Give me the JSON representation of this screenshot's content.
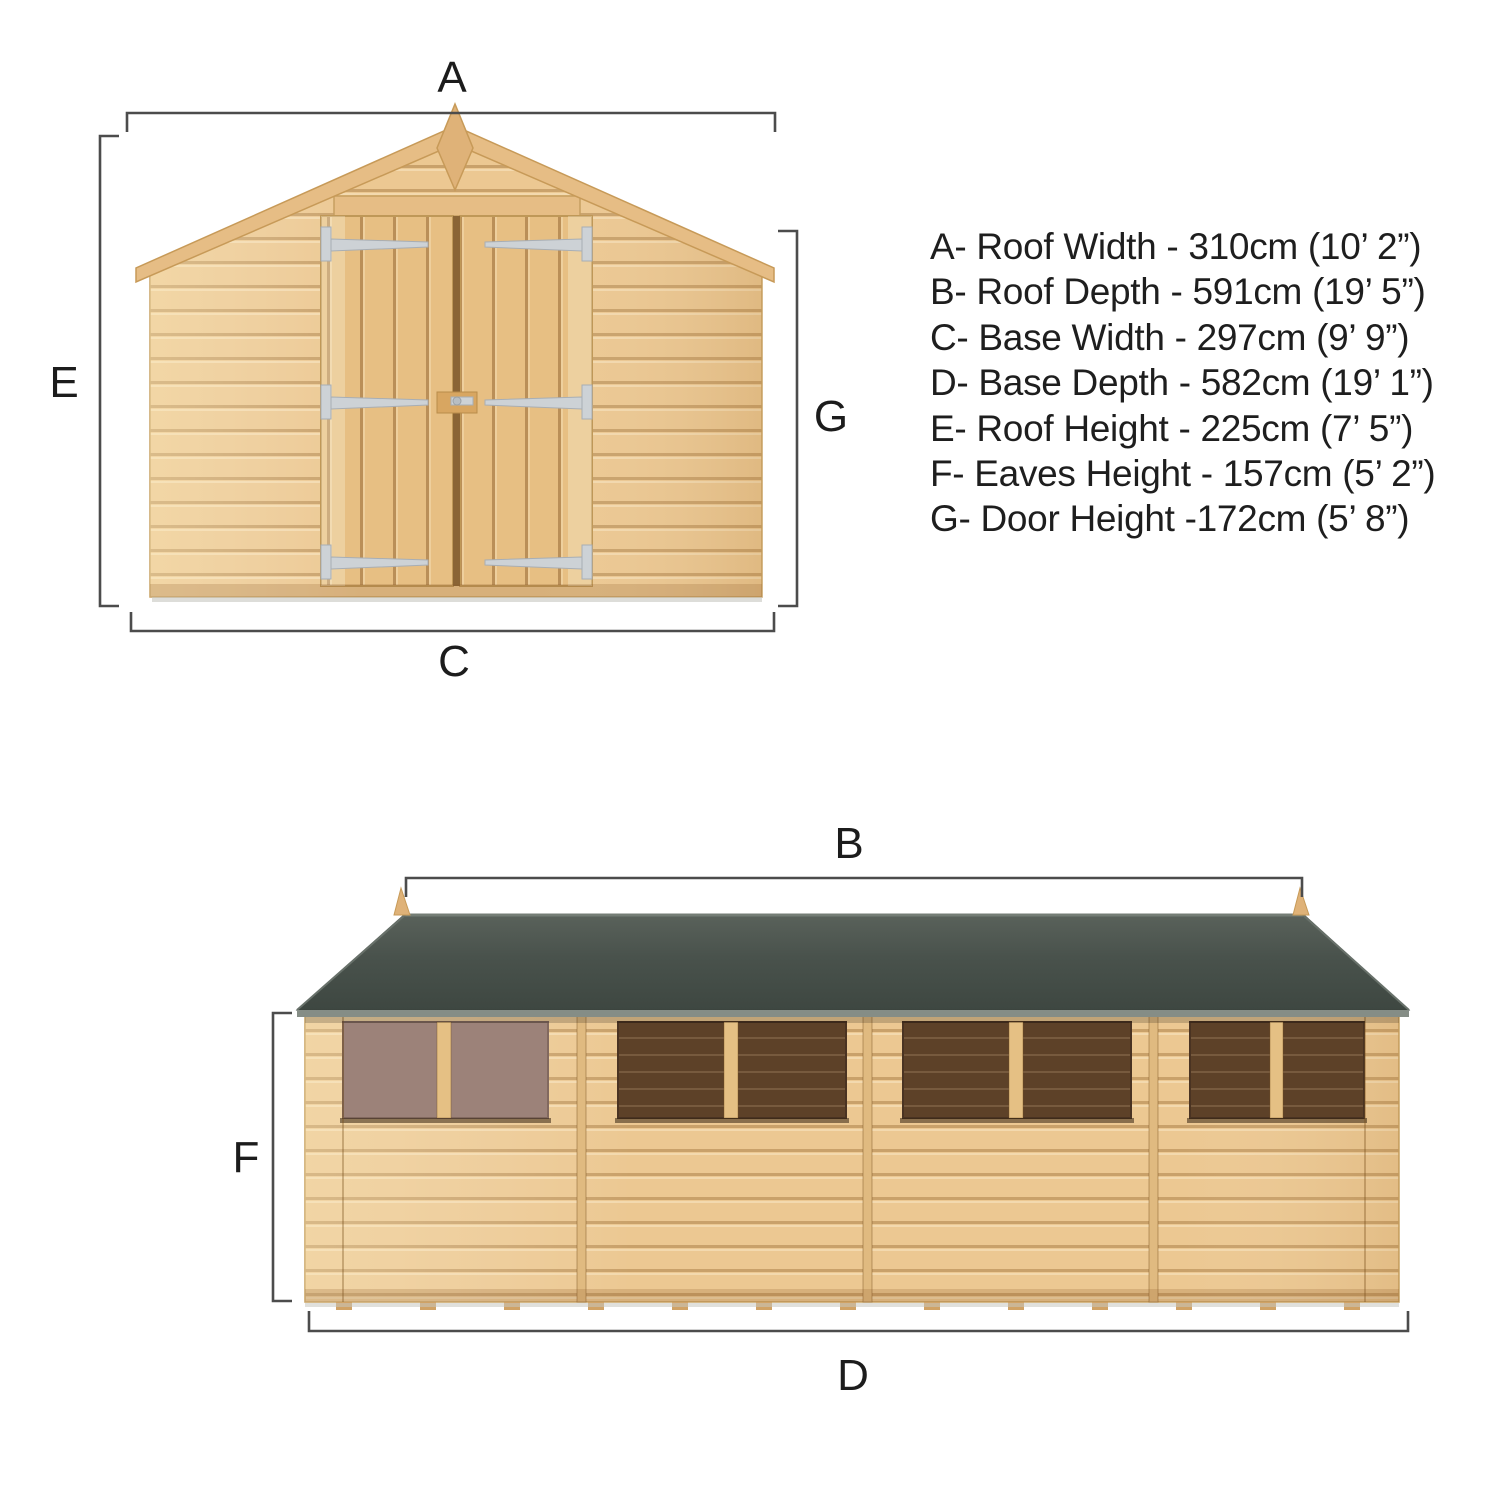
{
  "legend": {
    "items": [
      "A- Roof Width - 310cm (10’ 2”)",
      "B- Roof Depth - 591cm (19’ 5”)",
      "C- Base Width - 297cm (9’ 9”)",
      "D- Base Depth - 582cm (19’ 1”)",
      "E- Roof Height - 225cm (7’ 5”)",
      "F- Eaves Height - 157cm (5’ 2”)",
      "G- Door Height -172cm (5’ 8”)"
    ]
  },
  "front_view": {
    "labels": {
      "a": "A",
      "c": "C",
      "e": "E",
      "g": "G"
    }
  },
  "side_view": {
    "labels": {
      "b": "B",
      "d": "D",
      "f": "F"
    }
  },
  "colors": {
    "text": "#1c1c1c",
    "dim_line": "#4c4c4c",
    "wood_base": "#ecc892",
    "wood_door": "#e7bf83",
    "wood_trim": "#e6bd85",
    "finial": "#dfb278",
    "roof_felt": "#49524c",
    "roof_edge": "#858d86",
    "window_glazed": "#9c8279",
    "window_open": "#5d4128",
    "hinge_metal": "#cdd2d6",
    "shadow": "#c6c6bf"
  }
}
